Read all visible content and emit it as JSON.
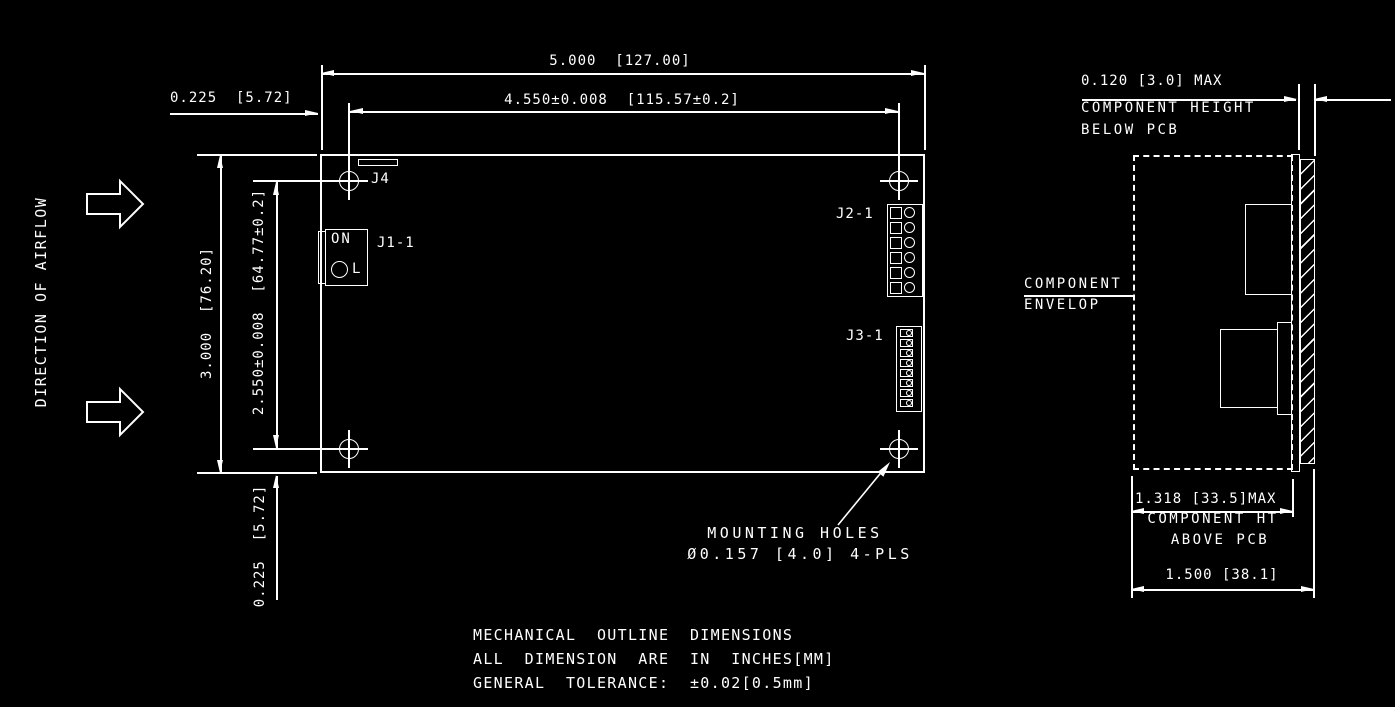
{
  "colors": {
    "background": "#000000",
    "line": "#ffffff"
  },
  "airflow": {
    "label": "DIRECTION OF AIRFLOW"
  },
  "main_view": {
    "dims": {
      "width": "5.000  [127.00]",
      "hole_span_x": "4.550±0.008  [115.57±0.2]",
      "edge_to_hole_top": "0.225  [5.72]",
      "height": "3.000  [76.20]",
      "hole_span_y": "2.550±0.008  [64.77±0.2]",
      "edge_to_hole_bottom": "0.225  [5.72]"
    },
    "labels": {
      "j4": "J4",
      "j1": "J1-1",
      "j1_switch_on": "ON",
      "j1_switch_l": "L",
      "j2": "J2-1",
      "j3": "J3-1"
    },
    "mounting_holes_note": {
      "line1": "MOUNTING HOLES",
      "line2": "Ø0.157 [4.0] 4-PLS"
    }
  },
  "side_view": {
    "dims": {
      "below_pcb": "0.120 [3.0] MAX",
      "below_pcb_label1": "COMPONENT HEIGHT",
      "below_pcb_label2": "BELOW PCB",
      "envelope_label1": "COMPONENT",
      "envelope_label2": "ENVELOP",
      "above_pcb": "1.318 [33.5]MAX",
      "above_pcb_label1": "COMPONENT HT",
      "above_pcb_label2": "ABOVE PCB",
      "overall": "1.500 [38.1]"
    }
  },
  "notes": {
    "line1": "MECHANICAL  OUTLINE  DIMENSIONS",
    "line2": "ALL  DIMENSION  ARE  IN  INCHES[MM]",
    "line3": "GENERAL  TOLERANCE:  ±0.02[0.5mm]"
  }
}
